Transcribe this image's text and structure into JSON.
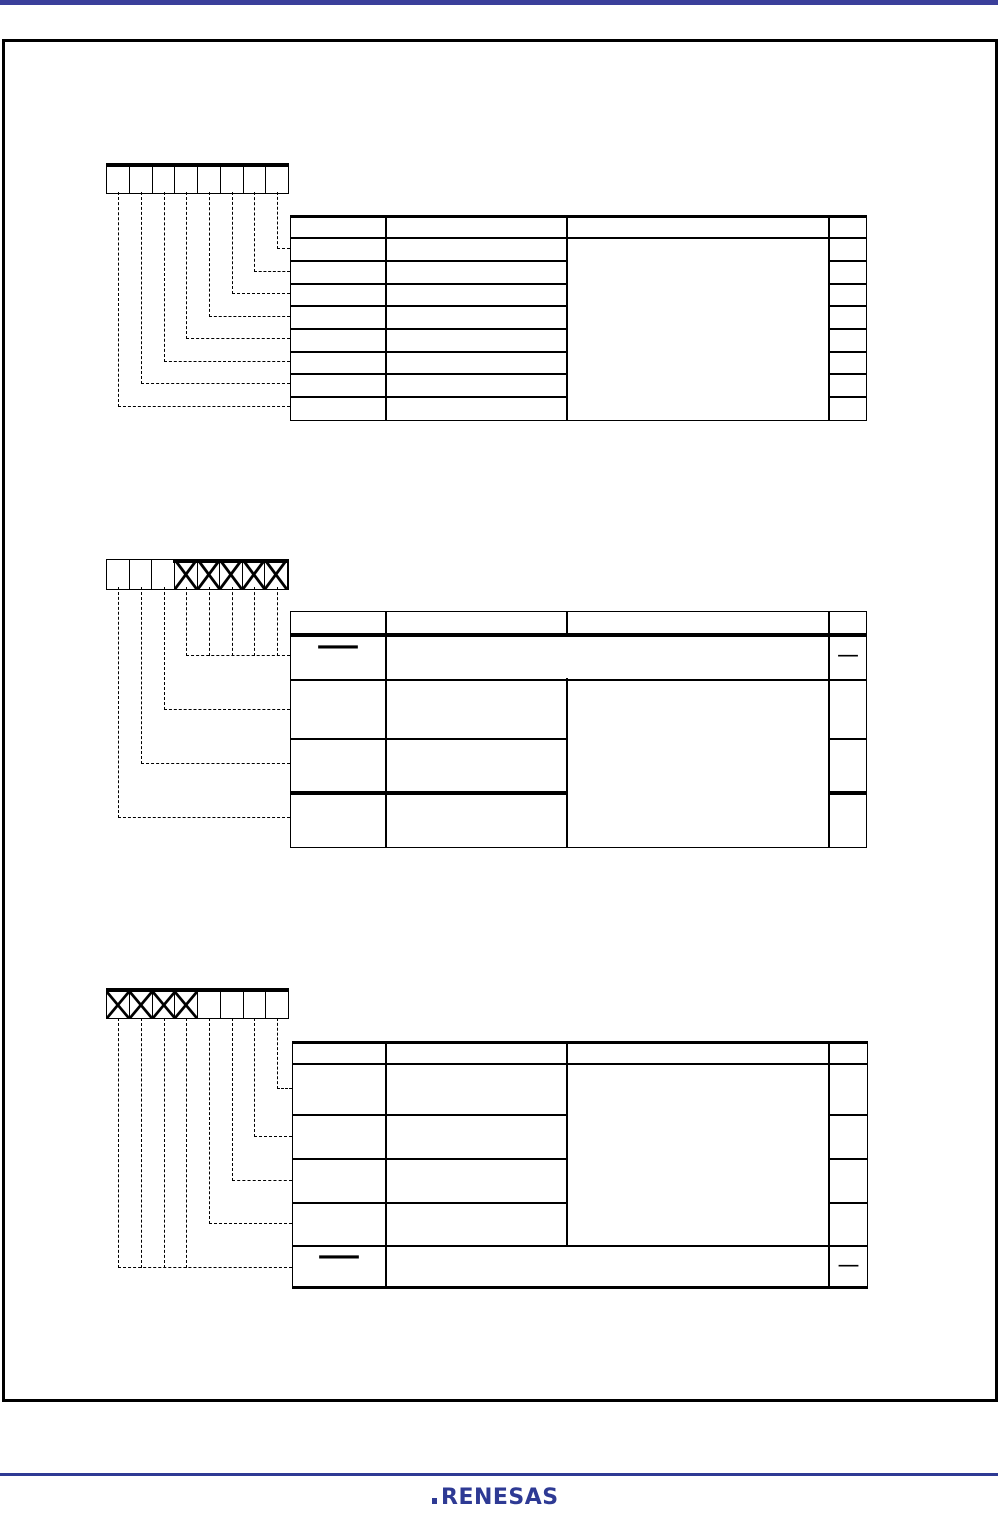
{
  "colors": {
    "top_bar_blue": "#3b3f9b",
    "footer_rule_blue": "#2e3a94",
    "logo_blue": "#2e3a94",
    "line_black": "#000000"
  },
  "footer": {
    "logo_text": "RENESAS"
  },
  "figures": [
    {
      "bit_count": 8,
      "bit_x_marks": [
        false,
        false,
        false,
        false,
        false,
        false,
        false,
        false
      ],
      "table": {
        "columns": 4,
        "header_cells": [
          "",
          "",
          "",
          ""
        ],
        "body_rows": 8,
        "all_cells_empty": true
      }
    },
    {
      "bit_count": 8,
      "bit_x_marks": [
        false,
        false,
        false,
        true,
        true,
        true,
        true,
        true
      ],
      "table": {
        "columns": 4,
        "header_cells": [
          "",
          "",
          "",
          ""
        ],
        "body_rows": 4,
        "reserved_row": {
          "bit_cell": "—",
          "rw_cell": "—"
        }
      }
    },
    {
      "bit_count": 8,
      "bit_x_marks": [
        true,
        true,
        true,
        true,
        false,
        false,
        false,
        false
      ],
      "table": {
        "columns": 4,
        "header_cells": [
          "",
          "",
          "",
          ""
        ],
        "body_rows": 5,
        "reserved_row": {
          "bit_cell": "—",
          "rw_cell": "—"
        }
      }
    }
  ]
}
